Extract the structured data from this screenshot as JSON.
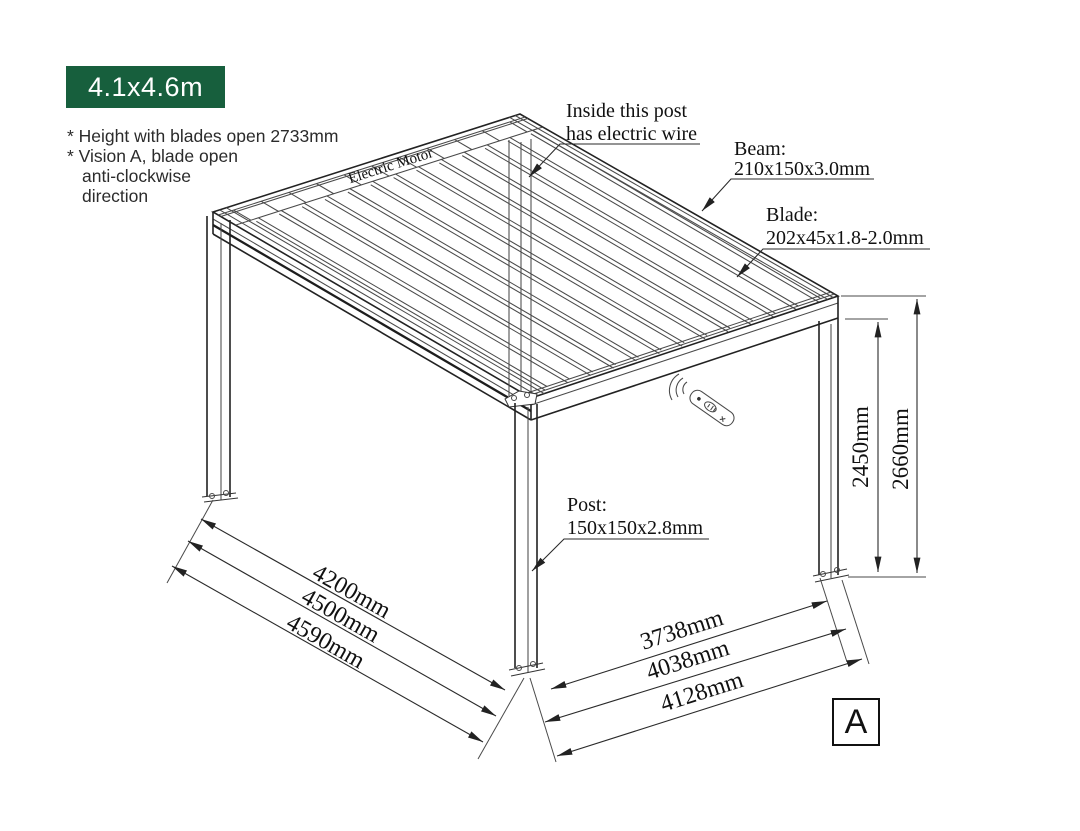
{
  "badge": {
    "label": "4.1x4.6m",
    "bg_color": "#175f3d"
  },
  "notes": {
    "line1": "* Height with blades open 2733mm",
    "line2": "* Vision A, blade open",
    "line3": "anti-clockwise",
    "line4": "direction"
  },
  "colors": {
    "badge_bg": "#175f3d",
    "drawing_line": "#4a4a4a",
    "text": "#111111"
  },
  "diagram": {
    "motor_label": "Electric Motor",
    "callout_wire_line1": "Inside this post",
    "callout_wire_line2": "has electric wire",
    "callout_beam_title": "Beam:",
    "callout_beam_spec": "210x150x3.0mm",
    "callout_blade_title": "Blade:",
    "callout_blade_spec": "202x45x1.8-2.0mm",
    "callout_post_title": "Post:",
    "callout_post_spec": "150x150x2.8mm",
    "dim_left": [
      "4200mm",
      "4500mm",
      "4590mm"
    ],
    "dim_right": [
      "3738mm",
      "4038mm",
      "4128mm"
    ],
    "dim_height_inner": "2450mm",
    "dim_height_outer": "2660mm",
    "view_label": "A"
  }
}
